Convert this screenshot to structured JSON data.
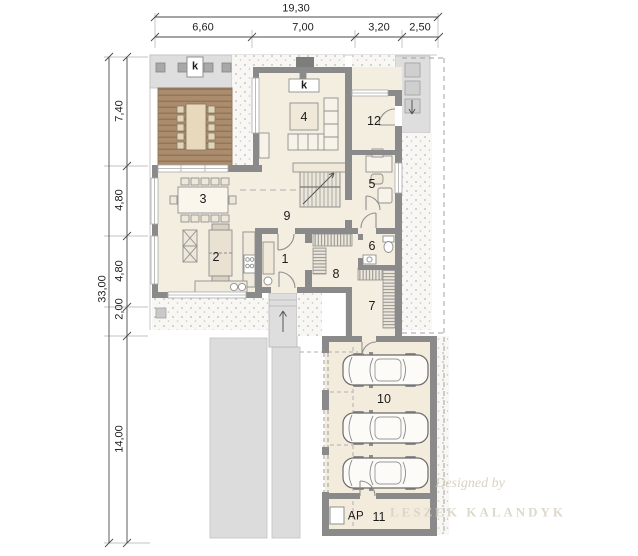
{
  "dimensions": {
    "top": {
      "total": "19,30",
      "segments": [
        "6,60",
        "7,00",
        "3,20",
        "2,50"
      ]
    },
    "left": {
      "total": "33,00",
      "segments": [
        "7,40",
        "4,80",
        "4,80",
        "2,00",
        "14,00"
      ]
    }
  },
  "rooms": {
    "r1": "1",
    "r2": "2",
    "r3": "3",
    "r4": "4",
    "r5": "5",
    "r6": "6",
    "r7": "7",
    "r8": "8",
    "r9": "9",
    "r10": "10",
    "r11": "11",
    "r12": "12"
  },
  "labels": {
    "chimney_terrace": "k",
    "chimney_living": "k",
    "heat_pump": "AP"
  },
  "watermark": {
    "line1": "Designed by",
    "line2": "LESZEK KALANDYK"
  },
  "colors": {
    "paving": "#dedede",
    "gravel_dot": "#b8b8b8",
    "wall": "#8a8a8a",
    "floor": "#f4eee1",
    "deck": "#ab8d6d",
    "deck_stripe": "#8d7156",
    "dimension_line": "#4a4a4a"
  }
}
